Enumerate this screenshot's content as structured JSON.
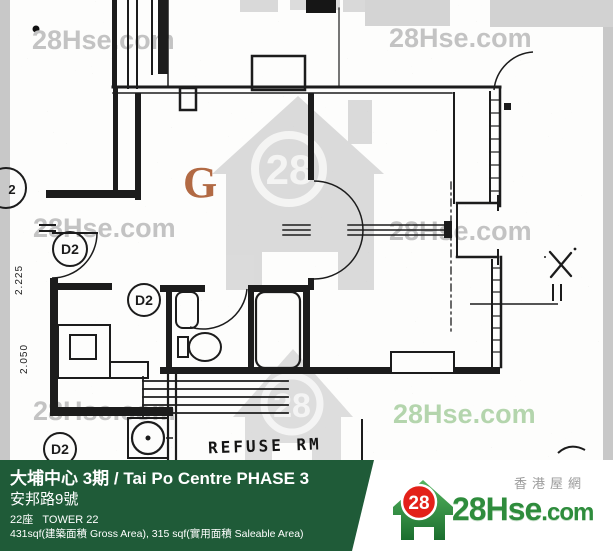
{
  "watermark": {
    "text": "28Hse.com",
    "green_text": "28Hse.com",
    "number": "28"
  },
  "plan": {
    "unit_label": "G",
    "refuse_room_label": "REFUSE RM",
    "door_labels": [
      "D2",
      "D2",
      "D2"
    ],
    "partial_door_label": "2",
    "dimensions": [
      "2.225",
      "2.050"
    ],
    "x_mark": "X"
  },
  "footer": {
    "title": "大埔中心 3期 / Tai Po Centre PHASE 3",
    "address": "安邦路9號",
    "tower": "22座   TOWER 22",
    "area": "431sqf(建築面積 Gross Area), 315 sqf(實用面積 Saleable Area)",
    "logo": {
      "number": "28",
      "site_main": "28Hse",
      "site_suffix": ".com",
      "tagline": "香港屋網"
    },
    "colors": {
      "bar_green": "#1f5b38",
      "logo_green": "#2e8c3c",
      "logo_red": "#e32119"
    }
  }
}
